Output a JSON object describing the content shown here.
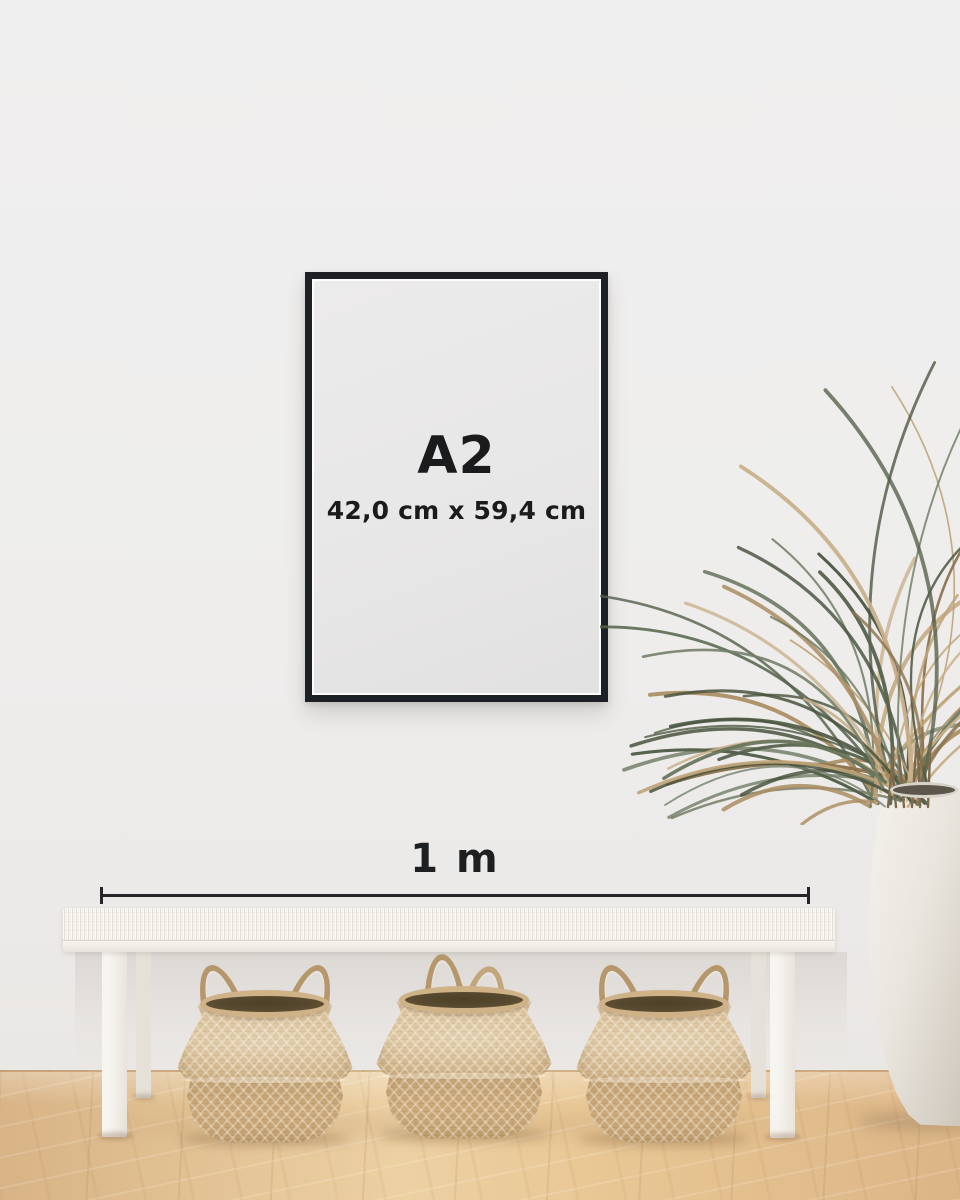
{
  "poster": {
    "size_label": "A2",
    "dimensions_label": "42,0 cm x 59,4 cm"
  },
  "scale_bar": {
    "label": "1 m"
  },
  "colors": {
    "wall": "#eeedec",
    "frame": "#1d2024",
    "poster": "#e8e7e7",
    "text": "#1a1b1d",
    "bench": "#f6f4f0",
    "basket": "#cfb287",
    "basket_interior": "#57492f",
    "vase": "#e9e5de",
    "leaf_green": "#55614a",
    "leaf_dry": "#ab8e64"
  }
}
